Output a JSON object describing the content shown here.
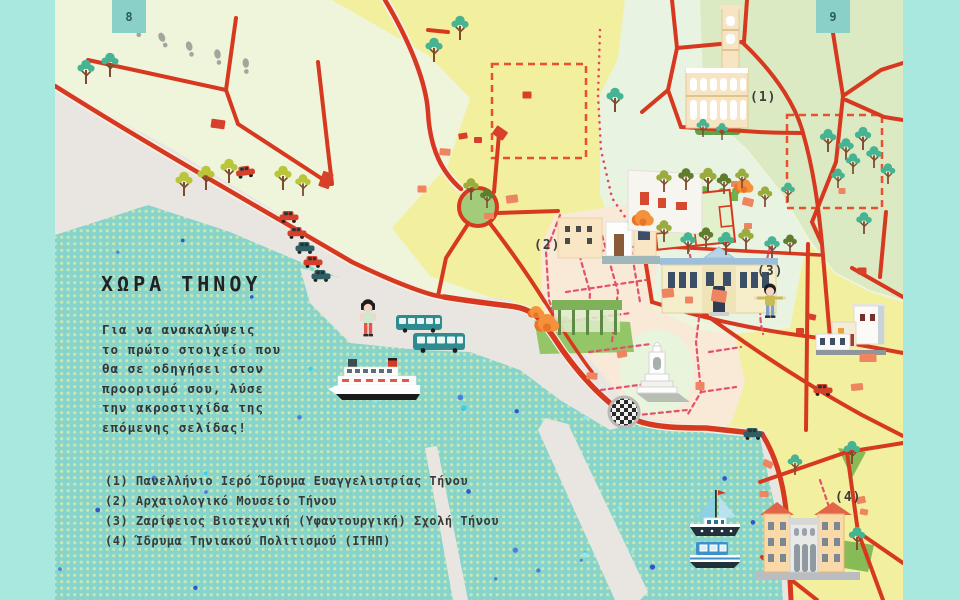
{
  "pages": {
    "left": "8",
    "right": "9"
  },
  "title": "ΧΩΡΑ ΤΗΝΟΥ",
  "intro_lines": [
    "Για να ανακαλύψεις",
    "το πρώτο στοιχείο που",
    "θα σε οδηγήσει στον",
    "προορισμό σου, λύσε",
    "την ακροστιχίδα της",
    "επόμενης σελίδας!"
  ],
  "legend_items": [
    {
      "num": "(1)",
      "text": "Πανελλήνιο Ιερό Ίδρυμα Ευαγγελιστρίας Τήνου"
    },
    {
      "num": "(2)",
      "text": "Αρχαιολογικό Μουσείο Τήνου"
    },
    {
      "num": "(3)",
      "text": "Ζαρίφειος Βιοτεχνική (Υφαντουργική) Σχολή Τήνου"
    },
    {
      "num": "(4)",
      "text": "Ίδρυμα Τηνιακού Πολιτισμού (ΙΤΗΠ)"
    }
  ],
  "markers": [
    {
      "label": "(1)",
      "x": 750,
      "y": 90
    },
    {
      "label": "(2)",
      "x": 534,
      "y": 238
    },
    {
      "label": "(3)",
      "x": 757,
      "y": 264
    },
    {
      "label": "(4)",
      "x": 835,
      "y": 490
    }
  ],
  "colors": {
    "road": "#d6391f",
    "dashed_street": "#e5506b",
    "dashed_zone": "#e8502e",
    "sea": "#86d4cc",
    "sea_dot": "#c9e7b0",
    "side_strip": "#a8e8de",
    "page_square": "#8ad0c8",
    "land": "#eff5da",
    "yellow_zone": "#f2ef9f",
    "mint_zone": "#e8f3e2",
    "olive_zone": "#dceac3",
    "old_town": "#f9e9d7",
    "shore": "#e9e6e2",
    "tree": {
      "teal": "#46b393",
      "olive": "#9aac3b",
      "yellow": "#b9c63a",
      "dark": "#5f7d2c"
    },
    "car": {
      "red": "#d5402b",
      "teal": "#2f5f63"
    },
    "block": {
      "orange": "#ee8560",
      "red": "#d7402a"
    }
  },
  "decorations": {
    "trees": [
      [
        86,
        84,
        "teal",
        1
      ],
      [
        110,
        77,
        "teal",
        1
      ],
      [
        184,
        196,
        "yellow",
        1
      ],
      [
        206,
        190,
        "yellow",
        1
      ],
      [
        229,
        183,
        "yellow",
        1
      ],
      [
        283,
        190,
        "yellow",
        1
      ],
      [
        303,
        196,
        "yellow",
        0.9
      ],
      [
        460,
        40,
        "teal",
        1
      ],
      [
        434,
        62,
        "teal",
        1
      ],
      [
        615,
        112,
        "teal",
        1
      ],
      [
        703,
        137,
        "teal",
        0.75
      ],
      [
        722,
        140,
        "teal",
        0.7
      ],
      [
        664,
        192,
        "olive",
        0.9
      ],
      [
        686,
        190,
        "dark",
        0.9
      ],
      [
        708,
        192,
        "olive",
        1
      ],
      [
        724,
        194,
        "dark",
        0.85
      ],
      [
        742,
        188,
        "olive",
        0.8
      ],
      [
        471,
        200,
        "olive",
        0.9
      ],
      [
        487,
        208,
        "dark",
        0.8
      ],
      [
        664,
        242,
        "olive",
        0.9
      ],
      [
        688,
        254,
        "teal",
        0.9
      ],
      [
        706,
        248,
        "dark",
        0.85
      ],
      [
        726,
        255,
        "teal",
        0.95
      ],
      [
        746,
        250,
        "olive",
        0.9
      ],
      [
        772,
        258,
        "teal",
        0.9
      ],
      [
        790,
        254,
        "dark",
        0.8
      ],
      [
        828,
        152,
        "teal",
        0.95
      ],
      [
        846,
        160,
        "teal",
        0.9
      ],
      [
        863,
        150,
        "teal",
        0.95
      ],
      [
        853,
        174,
        "teal",
        0.85
      ],
      [
        874,
        168,
        "teal",
        0.9
      ],
      [
        838,
        188,
        "teal",
        0.8
      ],
      [
        888,
        184,
        "teal",
        0.85
      ],
      [
        864,
        234,
        "teal",
        0.9
      ],
      [
        765,
        207,
        "olive",
        0.85
      ],
      [
        788,
        202,
        "teal",
        0.8
      ],
      [
        852,
        464,
        "teal",
        0.95
      ],
      [
        857,
        550,
        "teal",
        0.95
      ],
      [
        795,
        475,
        "teal",
        0.85
      ]
    ],
    "cars": [
      [
        246,
        176,
        "red",
        -8
      ],
      [
        289,
        221,
        "red",
        0
      ],
      [
        297,
        237,
        "red",
        0
      ],
      [
        305,
        252,
        "teal",
        0
      ],
      [
        313,
        266,
        "red",
        0
      ],
      [
        321,
        280,
        "teal",
        0
      ],
      [
        823,
        394,
        "red",
        0
      ],
      [
        753,
        438,
        "teal",
        0
      ]
    ],
    "blocks": [
      [
        218,
        124,
        14,
        9,
        8,
        "red"
      ],
      [
        326,
        180,
        11,
        16,
        20,
        "red"
      ],
      [
        500,
        133,
        13,
        10,
        35,
        "red"
      ],
      [
        478,
        140,
        8,
        6,
        0,
        "red"
      ],
      [
        463,
        136,
        9,
        6,
        -10,
        "red"
      ],
      [
        445,
        152,
        11,
        7,
        5,
        "orange"
      ],
      [
        512,
        199,
        12,
        8,
        -8,
        "orange"
      ],
      [
        489,
        216,
        10,
        6,
        0,
        "orange"
      ],
      [
        422,
        189,
        9,
        7,
        0,
        "orange"
      ],
      [
        862,
        271,
        9,
        7,
        0,
        "red"
      ],
      [
        868,
        358,
        17,
        8,
        0,
        "orange"
      ],
      [
        857,
        387,
        12,
        7,
        -6,
        "orange"
      ],
      [
        800,
        331,
        8,
        6,
        0,
        "red"
      ],
      [
        812,
        317,
        8,
        6,
        12,
        "red"
      ],
      [
        842,
        191,
        7,
        6,
        0,
        "orange"
      ],
      [
        622,
        354,
        10,
        7,
        -10,
        "orange"
      ],
      [
        592,
        376,
        11,
        7,
        4,
        "orange"
      ],
      [
        700,
        386,
        9,
        8,
        0,
        "orange"
      ],
      [
        668,
        293,
        12,
        9,
        -6,
        "orange"
      ],
      [
        689,
        300,
        8,
        7,
        0,
        "orange"
      ],
      [
        719,
        296,
        15,
        12,
        8,
        "orange"
      ],
      [
        735,
        184,
        8,
        6,
        0,
        "orange"
      ],
      [
        748,
        202,
        11,
        8,
        14,
        "orange"
      ],
      [
        748,
        226,
        8,
        6,
        0,
        "orange"
      ],
      [
        768,
        464,
        10,
        7,
        25,
        "orange"
      ],
      [
        764,
        494,
        9,
        6,
        0,
        "orange"
      ],
      [
        861,
        500,
        9,
        7,
        -12,
        "orange"
      ],
      [
        864,
        512,
        8,
        6,
        10,
        "orange"
      ],
      [
        527,
        95,
        9,
        7,
        0,
        "red"
      ]
    ],
    "footprints": [
      [
        136,
        30,
        -30
      ],
      [
        163,
        40,
        -24
      ],
      [
        190,
        49,
        -16
      ],
      [
        218,
        57,
        -10
      ],
      [
        246,
        66,
        -4
      ]
    ],
    "bushes": [
      [
        643,
        218,
        8
      ],
      [
        744,
        186,
        7
      ],
      [
        547,
        323,
        9
      ],
      [
        536,
        312,
        6
      ]
    ]
  }
}
